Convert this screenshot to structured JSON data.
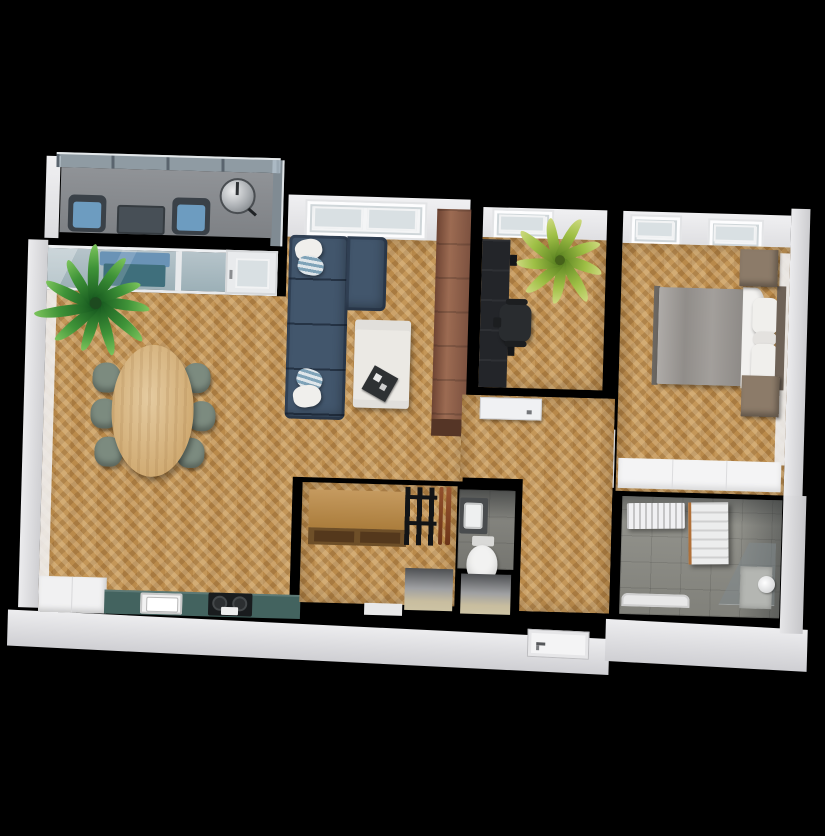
{
  "scene": {
    "title": "3D apartment floor plan, top-down view on black background",
    "background": "#000000"
  },
  "colors": {
    "wall": "#000000",
    "exterior_face": "#e6e6e8",
    "wood_floor": "#c1914f",
    "concrete_floor": "#8f8f88",
    "balcony_floor": "#87898d",
    "glass": "#b6c4ca",
    "sofa_blue": "#42566c",
    "cushion_blue": "#6d9cc0",
    "dining_chair_green": "#7c8b7f",
    "dining_table_oak": "#d9b98e",
    "tall_cabinet_walnut": "#8a5c48",
    "kitchen_counter_teal": "#43635f",
    "bed_duvet_gray": "#9d9995",
    "nightstand_wood": "#8c7b69",
    "plant_green": "#3f9338",
    "office_plant_green": "#9ebf45"
  },
  "rooms": {
    "balcony": {
      "label": "balcony"
    },
    "living_room": {
      "label": "living room with open kitchen"
    },
    "office": {
      "label": "office"
    },
    "bedroom": {
      "label": "bedroom"
    },
    "hallway": {
      "label": "hallway"
    },
    "wc": {
      "label": "toilet room"
    },
    "storage": {
      "label": "storage room"
    },
    "bathroom": {
      "label": "bathroom"
    },
    "entry": {
      "label": "entry vestibule"
    }
  },
  "furniture": {
    "balcony": [
      "glass railing",
      "lounge chair x2 with blue cushions",
      "side table",
      "kettle grill",
      "bench behind glass doors"
    ],
    "living_room": [
      "blue corner sofa with pillows",
      "white coffee table with dark tray",
      "oval dining table",
      "dining chair x6",
      "large potted palm",
      "tall walnut cabinet",
      "teal kitchen counter with sink and hob",
      "white kitchen cabinet"
    ],
    "office": [
      "dark desk shelving unit",
      "office swivel chair",
      "palm plant"
    ],
    "bedroom": [
      "double bed with gray duvet and white pillows",
      "headboard",
      "nightstand x2",
      "white built-in wardrobe",
      "open door"
    ],
    "wc": [
      "washbasin",
      "toilet"
    ],
    "storage": [
      "wooden sideboard",
      "black coat rack",
      "closet niche"
    ],
    "bathroom": [
      "radiator",
      "white towel shelf",
      "corner shower with glass panel",
      "bathtub edge"
    ],
    "entry": [
      "entrance door with handle"
    ]
  }
}
